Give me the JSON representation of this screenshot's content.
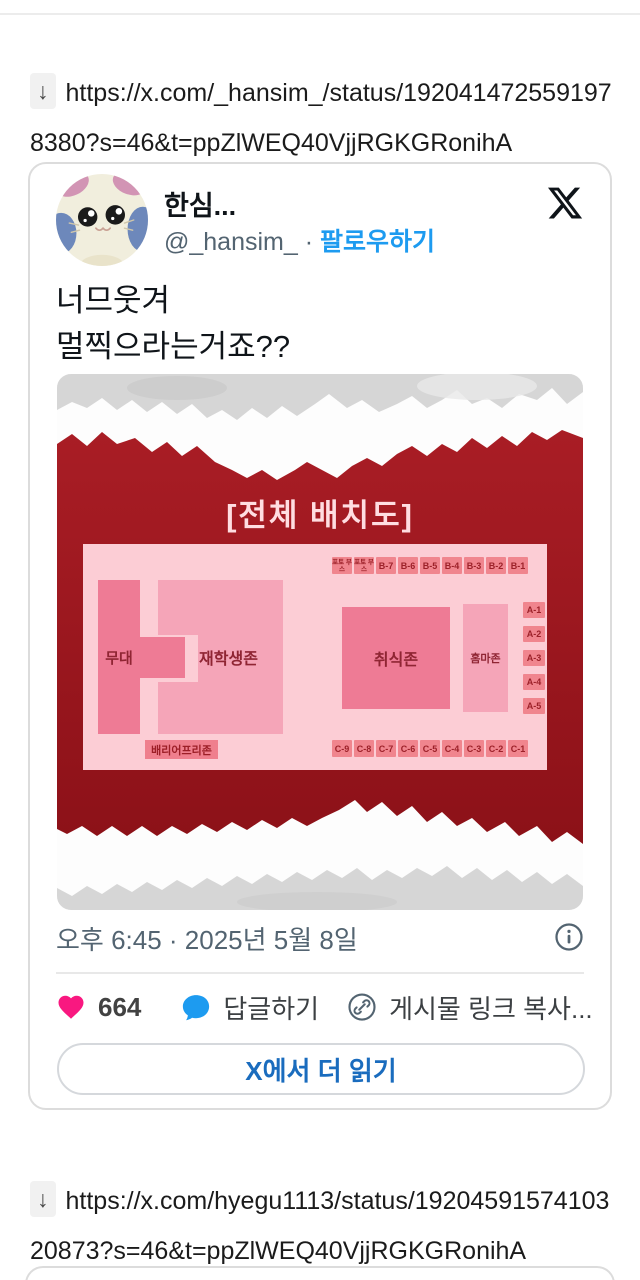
{
  "page": {
    "download_arrow": "↓",
    "url1": "https://x.com/_hansim_/status/1920414725591978380?s=46&t=ppZlWEQ40VjjRGKGRonihA",
    "url2": "https://x.com/hyegu1113/status/1920459157410320873?s=46&t=ppZlWEQ40VjjRGKGRonihA"
  },
  "tweet": {
    "display_name": "한심...",
    "handle": "@_hansim_",
    "separator": "·",
    "follow_label": "팔로우하기",
    "body_line1": "너므웃겨",
    "body_line2": "멀찍으라는거죠??",
    "timestamp": "오후 6:45 · 2025년 5월 8일",
    "like_count": "664",
    "reply_label": "답글하기",
    "copy_link_label": "게시물 링크 복사...",
    "read_more_label": "X에서 더 읽기"
  },
  "chart": {
    "title": "[전체 배치도]",
    "stage_label": "무대",
    "students_label": "재학생존",
    "food_label": "취식존",
    "homma_label": "홈마존",
    "barrier_free_label": "배리어프리존",
    "top_row": [
      "포토 부스",
      "포토 부스",
      "B-7",
      "B-6",
      "B-5",
      "B-4",
      "B-3",
      "B-2",
      "B-1"
    ],
    "a_col": [
      "A-1",
      "A-2",
      "A-3",
      "A-4",
      "A-5"
    ],
    "c_row": [
      "C-9",
      "C-8",
      "C-7",
      "C-6",
      "C-5",
      "C-4",
      "C-3",
      "C-2",
      "C-1"
    ]
  },
  "colors": {
    "accent_blue": "#1d9bf0",
    "read_more_blue": "#1a6cbe",
    "like_pink": "#f91880",
    "poster_red": "#a11c24",
    "map_pink": "#fccdd5",
    "zone_dark_pink": "#ee7b95",
    "zone_light_pink": "#f5a5b8",
    "seat_box_salmon": "#f0858e"
  }
}
